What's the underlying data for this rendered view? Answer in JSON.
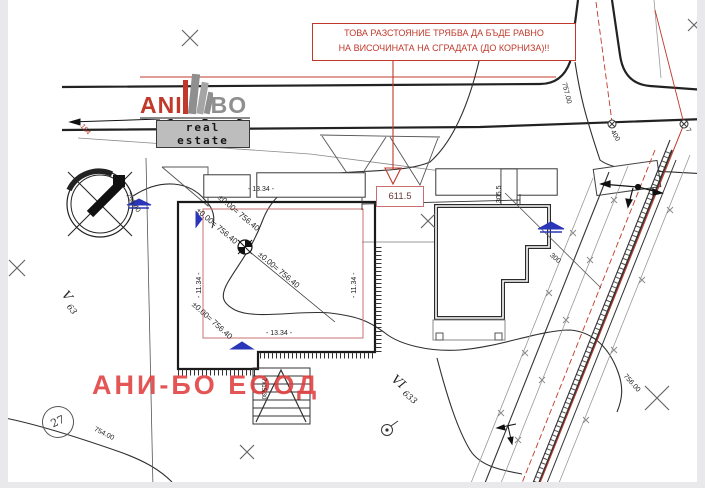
{
  "annotation": {
    "line1": "ТОВА РАЗСТОЯНИЕ ТРЯБВА ДА БЪДЕ РАВНО",
    "line2": "НА ВИСОЧИНАТА НА СГРАДАТА (ДО КОРНИЗА)!!",
    "target_value": "611.5"
  },
  "logo": {
    "ani": "ANI",
    "bo": "BO",
    "tagline": "real estate"
  },
  "watermark": {
    "text": "АНИ-БО ЕООД",
    "color": "#e03e3e"
  },
  "elevations": {
    "zero_1": "±0.00= 756.40",
    "zero_2": "±0.00= 756.40",
    "zero_3": "±0.00= 756.40",
    "zero_4": "±0.00= 756.40",
    "circle_label": "756.40"
  },
  "dimensions": {
    "width_top": "- 13.34 -",
    "width_bottom": "- 13.34 -",
    "depth_left": "- 11.34 -",
    "depth_right": "- 11.34 -",
    "dist_300": "300",
    "dist_305": "305.5",
    "stairs_note": "7x15/30"
  },
  "contours": {
    "c757": "757.00",
    "c756": "756.00",
    "c754": "754.00"
  },
  "survey": {
    "pt_400": "400",
    "pt_right": "7",
    "axis_154": "154"
  },
  "parcels": {
    "v": "V",
    "v_sub": "63",
    "vi": "VI",
    "vi_sub": "633",
    "num_27": "27"
  },
  "colors": {
    "accent_red": "#c0392b",
    "marker_blue": "#2a35b8",
    "line_dark": "#2a2a2a"
  }
}
